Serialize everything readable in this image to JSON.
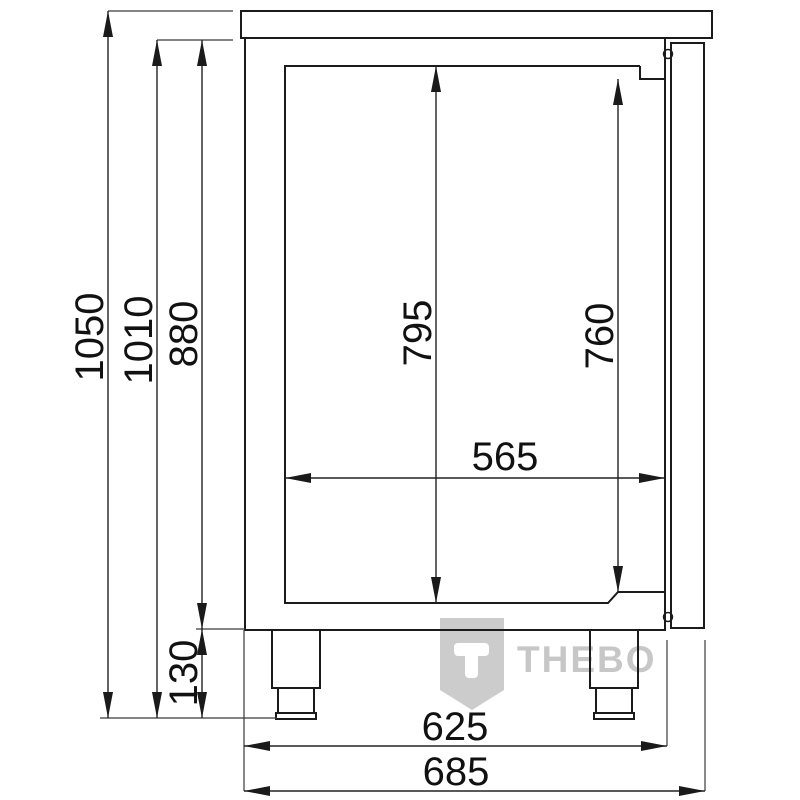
{
  "watermark": {
    "brand": "THEBO"
  },
  "dimensions": {
    "overall_height": "1050",
    "body_height": "1010",
    "cabinet_height": "880",
    "leg_height": "130",
    "inner_height_rear": "795",
    "inner_height_front": "760",
    "inner_depth": "565",
    "base_depth": "625",
    "overall_depth": "685"
  },
  "colors": {
    "drawing_line": "#1b1b1b",
    "dimension_line": "#222222",
    "extension_line": "#3a3a3a",
    "watermark_gray": "#cccccc"
  }
}
